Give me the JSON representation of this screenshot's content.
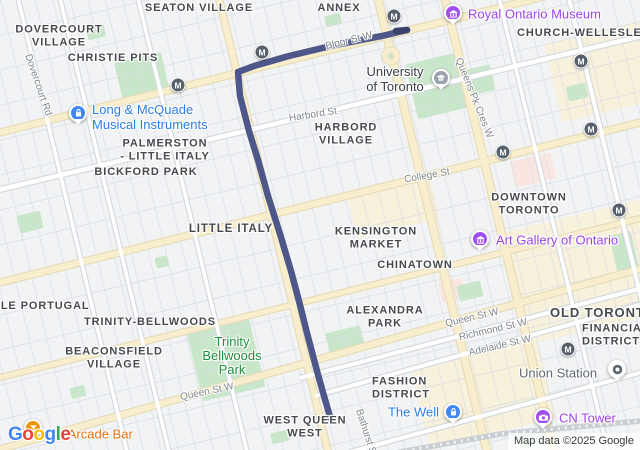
{
  "map": {
    "attribution": "Map data ©2025 Google",
    "google_logo": [
      {
        "ch": "G",
        "color": "#4285F4"
      },
      {
        "ch": "o",
        "color": "#EA4335"
      },
      {
        "ch": "o",
        "color": "#FBBC04"
      },
      {
        "ch": "g",
        "color": "#4285F4"
      },
      {
        "ch": "l",
        "color": "#34A853"
      },
      {
        "ch": "e",
        "color": "#EA4335"
      }
    ],
    "area_labels": [
      {
        "id": "dovercourt-village",
        "lines": [
          "DOVERCOURT",
          "VILLAGE"
        ],
        "x": 59,
        "y": 36
      },
      {
        "id": "seaton-village",
        "lines": [
          "SEATON VILLAGE"
        ],
        "x": 199,
        "y": 8
      },
      {
        "id": "annex",
        "lines": [
          "ANNEX"
        ],
        "x": 339,
        "y": 8
      },
      {
        "id": "christie-pits",
        "lines": [
          "CHRISTIE PITS"
        ],
        "x": 113,
        "y": 58
      },
      {
        "id": "church-wellesley",
        "lines": [
          "CHURCH-WELLESLEY"
        ],
        "x": 517,
        "y": 33,
        "anchor": "left"
      },
      {
        "id": "palmerston-little-italy",
        "lines": [
          "PALMERSTON",
          "- LITTLE ITALY"
        ],
        "x": 165,
        "y": 150
      },
      {
        "id": "bickford-park",
        "lines": [
          "BICKFORD PARK"
        ],
        "x": 146,
        "y": 172
      },
      {
        "id": "harbord-village",
        "lines": [
          "HARBORD",
          "VILLAGE"
        ],
        "x": 346,
        "y": 134
      },
      {
        "id": "little-italy",
        "lines": [
          "LITTLE ITALY"
        ],
        "x": 231,
        "y": 229,
        "fs": 11.5
      },
      {
        "id": "kensington-market",
        "lines": [
          "KENSINGTON",
          "MARKET"
        ],
        "x": 376,
        "y": 238
      },
      {
        "id": "chinatown",
        "lines": [
          "CHINATOWN"
        ],
        "x": 415,
        "y": 265
      },
      {
        "id": "downtown-toronto",
        "lines": [
          "DOWNTOWN",
          "TORONTO"
        ],
        "x": 529,
        "y": 204
      },
      {
        "id": "old-toronto",
        "lines": [
          "OLD TORONTO"
        ],
        "x": 550,
        "y": 313,
        "anchor": "left",
        "fs": 13
      },
      {
        "id": "financial-district",
        "lines": [
          "FINANCIAL",
          "DISTRICT"
        ],
        "x": 582,
        "y": 335,
        "anchor": "left"
      },
      {
        "id": "little-portugal",
        "lines": [
          "LITTLE PORTUGAL"
        ],
        "x": -26,
        "y": 306,
        "anchor": "left"
      },
      {
        "id": "trinity-bellwoods",
        "lines": [
          "TRINITY-BELLWOODS"
        ],
        "x": 150,
        "y": 322
      },
      {
        "id": "beaconsfield-village",
        "lines": [
          "BEACONSFIELD",
          "VILLAGE"
        ],
        "x": 114,
        "y": 358
      },
      {
        "id": "alexandra-park",
        "lines": [
          "ALEXANDRA",
          "PARK"
        ],
        "x": 385,
        "y": 317
      },
      {
        "id": "fashion-district",
        "lines": [
          "FASHION",
          "DISTRICT"
        ],
        "x": 372,
        "y": 388,
        "anchor": "left"
      },
      {
        "id": "west-queen-west",
        "lines": [
          "WEST QUEEN",
          "WEST"
        ],
        "x": 305,
        "y": 427
      }
    ],
    "street_labels": [
      {
        "id": "dovercourt-rd",
        "text": "Dovercourt Rd",
        "x": 38,
        "y": 85,
        "rot": 71
      },
      {
        "id": "bloor-st-w",
        "text": "Bloor St W",
        "x": 349,
        "y": 41,
        "rot": -14
      },
      {
        "id": "harbord-st",
        "text": "Harbord St",
        "x": 313,
        "y": 115,
        "rot": -9
      },
      {
        "id": "college-st",
        "text": "College St",
        "x": 427,
        "y": 176,
        "rot": -10
      },
      {
        "id": "queens-pk-cres-w",
        "text": "Queens Pk Cres W",
        "x": 474,
        "y": 98,
        "rot": 68
      },
      {
        "id": "queen-st-w-west",
        "text": "Queen St W",
        "x": 207,
        "y": 392,
        "rot": -12
      },
      {
        "id": "queen-st-w-east",
        "text": "Queen St W",
        "x": 472,
        "y": 318,
        "rot": -13
      },
      {
        "id": "richmond-st-w",
        "text": "Richmond St W",
        "x": 493,
        "y": 330,
        "rot": -13
      },
      {
        "id": "adelaide-st-w",
        "text": "Adelaide St W",
        "x": 500,
        "y": 346,
        "rot": -13
      },
      {
        "id": "bathurst-st",
        "text": "Bathurst St",
        "x": 366,
        "y": 433,
        "rot": 72
      }
    ],
    "park_labels": [
      {
        "id": "trinity-bellwoods-park",
        "lines": [
          "Trinity",
          "Bellwoods",
          "Park"
        ],
        "x": 232,
        "y": 356,
        "color": "#1e8e3e"
      }
    ],
    "pois": [
      {
        "id": "long-and-mcquade",
        "lines": [
          "Long & McQuade",
          "Musical Instruments"
        ],
        "text_color": "#2b7de9",
        "icon": "bag",
        "pin_color": "#4285f4",
        "icon_x": 78,
        "icon_y": 113,
        "text_x": 92,
        "text_y": 117,
        "anchor": "left"
      },
      {
        "id": "royal-ontario-museum",
        "lines": [
          "Royal Ontario Museum"
        ],
        "text_color": "#9d43ea",
        "icon": "museum",
        "pin_color": "#a04fee",
        "icon_x": 453,
        "icon_y": 13,
        "text_x": 468,
        "text_y": 14,
        "anchor": "left"
      },
      {
        "id": "university-of-toronto",
        "lines": [
          "University",
          "of Toronto"
        ],
        "text_color": "#3a4045",
        "icon": "grad",
        "pin_color": "#9aa3ab",
        "icon_x": 441,
        "icon_y": 78,
        "text_x": 395,
        "text_y": 79,
        "anchor": "center"
      },
      {
        "id": "art-gallery-of-ontario",
        "lines": [
          "Art Gallery of Ontario"
        ],
        "text_color": "#9d43ea",
        "icon": "museum",
        "pin_color": "#a04fee",
        "icon_x": 480,
        "icon_y": 239,
        "text_x": 496,
        "text_y": 240,
        "anchor": "left"
      },
      {
        "id": "union-station",
        "lines": [
          "Union Station"
        ],
        "text_color": "#62686e",
        "icon": "station",
        "pin_color": "#ffffff",
        "icon_x": 617,
        "icon_y": 369,
        "text_x": 519,
        "text_y": 373,
        "anchor": "left"
      },
      {
        "id": "cn-tower",
        "lines": [
          "CN Tower"
        ],
        "text_color": "#9d43ea",
        "icon": "camera",
        "pin_color": "#a04fee",
        "icon_x": 543,
        "icon_y": 417,
        "text_x": 559,
        "text_y": 418,
        "anchor": "left"
      },
      {
        "id": "the-well",
        "lines": [
          "The Well"
        ],
        "text_color": "#2b7de9",
        "icon": "bag",
        "pin_color": "#4285f4",
        "icon_x": 453,
        "icon_y": 412,
        "text_x": 439,
        "text_y": 412,
        "anchor": "right"
      },
      {
        "id": "tilt-arcade-bar",
        "lines": [
          "Tilt Arcade Bar"
        ],
        "text_color": "#e8710a",
        "icon": "cocktail",
        "pin_color": "#f09300",
        "icon_x": 33,
        "icon_y": 428,
        "text_x": 48,
        "text_y": 434,
        "anchor": "left"
      }
    ],
    "subway_stations": [
      [
        178,
        85
      ],
      [
        262,
        52
      ],
      [
        394,
        16
      ],
      [
        503,
        152
      ],
      [
        581,
        61
      ],
      [
        591,
        129
      ],
      [
        619,
        210
      ],
      [
        568,
        349
      ]
    ],
    "route": {
      "color": "#4e578a",
      "width": 6.5,
      "cap_color": "#39426b",
      "points": [
        [
          407,
          30
        ],
        [
          382,
          36
        ],
        [
          335,
          45
        ],
        [
          289,
          56
        ],
        [
          254,
          66
        ],
        [
          238,
          72
        ],
        [
          240,
          96
        ],
        [
          249,
          131
        ],
        [
          258,
          160
        ],
        [
          268,
          196
        ],
        [
          280,
          234
        ],
        [
          291,
          271
        ],
        [
          299,
          301
        ],
        [
          307,
          333
        ],
        [
          317,
          371
        ],
        [
          324,
          396
        ],
        [
          331,
          420
        ]
      ],
      "start_cap": [
        [
          396,
          31
        ],
        [
          407,
          30
        ]
      ]
    },
    "basemap": {
      "bg": "#f2f3f5",
      "grid": {
        "angle": -13.5,
        "spacing_x": 17,
        "spacing_y": 34,
        "line_color": "#d9dee4",
        "line_width": 1.4
      },
      "zones": [
        {
          "cx": 585,
          "cy": 272,
          "w": 140,
          "h": 115,
          "color": "#f8f1dc"
        },
        {
          "cx": 483,
          "cy": 392,
          "w": 130,
          "h": 85,
          "color": "#f8f1dc"
        },
        {
          "cx": 602,
          "cy": 72,
          "w": 100,
          "h": 80,
          "color": "#f8f1dc"
        },
        {
          "cx": 393,
          "cy": 205,
          "w": 85,
          "h": 48,
          "color": "#f8f1dc"
        },
        {
          "cx": 533,
          "cy": 170,
          "w": 42,
          "h": 26,
          "color": "#fbe5e1"
        },
        {
          "cx": 452,
          "cy": 290,
          "w": 24,
          "h": 20,
          "color": "#fbe5e1"
        }
      ],
      "parks": [
        [
          142,
          77,
          48,
          40
        ],
        [
          437,
          86,
          52,
          56
        ],
        [
          480,
          80,
          26,
          26
        ],
        [
          226,
          360,
          64,
          70
        ],
        [
          345,
          340,
          36,
          22
        ],
        [
          470,
          291,
          24,
          16
        ],
        [
          30,
          222,
          24,
          18
        ],
        [
          96,
          32,
          18,
          13
        ],
        [
          333,
          20,
          16,
          11
        ],
        [
          577,
          92,
          20,
          15
        ],
        [
          624,
          252,
          22,
          38
        ],
        [
          532,
          438,
          30,
          13
        ],
        [
          162,
          262,
          13,
          11
        ],
        [
          78,
          392,
          15,
          11
        ],
        [
          280,
          437,
          18,
          11
        ]
      ],
      "park_color": "#c8e6c9",
      "roads": [
        {
          "x1": -10,
          "y1": 135,
          "x2": 650,
          "y2": -30,
          "t": "y",
          "w": 6
        },
        {
          "x1": -10,
          "y1": 285,
          "x2": 650,
          "y2": 120,
          "t": "y",
          "w": 6
        },
        {
          "x1": -10,
          "y1": 452,
          "x2": 650,
          "y2": 266,
          "t": "y",
          "w": 6
        },
        {
          "x1": -10,
          "y1": 380,
          "x2": 650,
          "y2": 216,
          "t": "y",
          "w": 5
        },
        {
          "x1": 217,
          "y1": -10,
          "x2": 330,
          "y2": 460,
          "t": "y",
          "w": 6
        },
        {
          "x1": 376,
          "y1": -10,
          "x2": 489,
          "y2": 460,
          "t": "y",
          "w": 7
        },
        {
          "x1": 443,
          "y1": -10,
          "x2": 556,
          "y2": 460,
          "t": "y",
          "w": 7
        },
        {
          "x1": -10,
          "y1": 192,
          "x2": 650,
          "y2": 34,
          "t": "w",
          "w": 4.5
        },
        {
          "x1": 300,
          "y1": 378,
          "x2": 650,
          "y2": 286,
          "t": "w",
          "w": 4
        },
        {
          "x1": 315,
          "y1": 396,
          "x2": 650,
          "y2": 302,
          "t": "w",
          "w": 4
        },
        {
          "x1": 350,
          "y1": 452,
          "x2": 650,
          "y2": 370,
          "t": "w",
          "w": 4
        },
        {
          "x1": 16,
          "y1": -10,
          "x2": 129,
          "y2": 460,
          "t": "w",
          "w": 3.5
        },
        {
          "x1": 58,
          "y1": -10,
          "x2": 171,
          "y2": 460,
          "t": "w",
          "w": 3.5
        },
        {
          "x1": 136,
          "y1": -10,
          "x2": 249,
          "y2": 460,
          "t": "w",
          "w": 3.5
        },
        {
          "x1": 497,
          "y1": -10,
          "x2": 610,
          "y2": 460,
          "t": "w",
          "w": 3.5
        },
        {
          "x1": 567,
          "y1": -10,
          "x2": 680,
          "y2": 460,
          "t": "w",
          "w": 4
        }
      ],
      "road_colors": {
        "y_fill": "#f8eecd",
        "y_case": "#e6dcba",
        "w_fill": "#ffffff",
        "w_case": "#d5dade"
      },
      "roundabout": {
        "cx": 391,
        "cy": 56
      },
      "railway": {
        "points": [
          [
            378,
            456
          ],
          [
            500,
            434
          ],
          [
            640,
            421
          ]
        ],
        "color": "#c9ced3"
      }
    }
  }
}
